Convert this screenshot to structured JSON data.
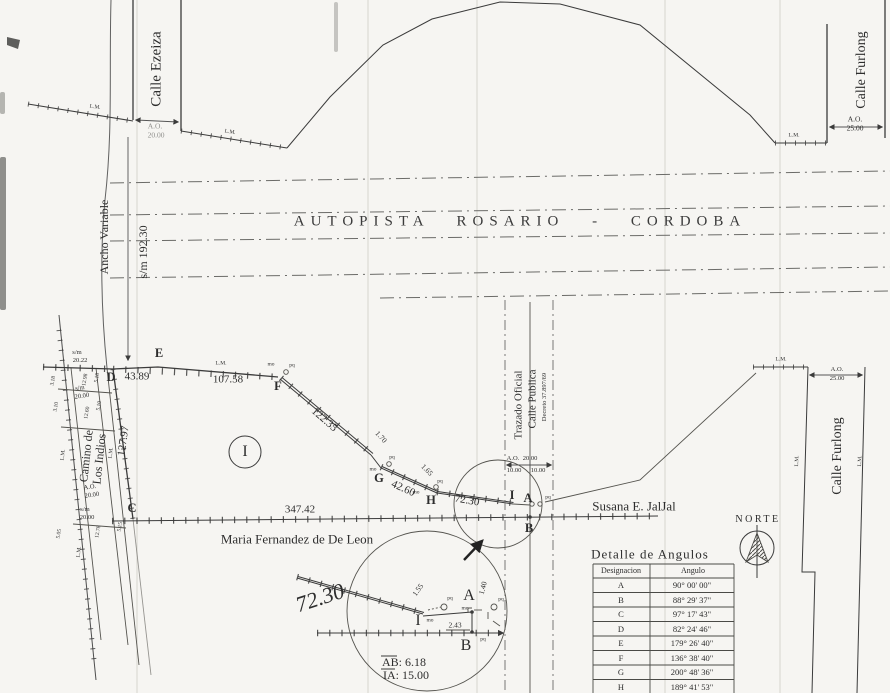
{
  "plan": {
    "autopista_title": "AUTOPISTA ROSARIO - CORDOBA",
    "north_label": "NORTE"
  },
  "streets": {
    "ezeiza": {
      "name": "Calle Ezeiza",
      "ao": "A.O.",
      "width": "20.00"
    },
    "furlong_top": {
      "name": "Calle Furlong",
      "ao": "A.O.",
      "width": "25.00"
    },
    "furlong_right": {
      "name": "Calle Furlong",
      "ao": "A.O.",
      "width": "25.00"
    },
    "autopista": {
      "ancho": "Ancho Variable",
      "sm": "s/m 192.30"
    },
    "camino": {
      "name1": "Camino de",
      "name2": "Los Indios",
      "ao": "A.O.",
      "ao_width": "20.00",
      "sm_top": "s/m",
      "sm_top_v": "20.22",
      "sm_mid": "s/m",
      "sm_mid_v": "20.00",
      "sm_bot": "s/m",
      "sm_bot_v": "20.00",
      "w_top": [
        "3.18",
        "12.98",
        "5.18"
      ],
      "w_mid": [
        "3.10",
        "12.60",
        "5.10"
      ],
      "w_bot": [
        "5.05",
        "12.78",
        "5.15"
      ]
    },
    "trazado": {
      "l1": "Trazado Oficial",
      "l2": "Calle Publica",
      "l3": "Decreto 37.897/69",
      "ao": "A.O.",
      "width": "20.00",
      "half1": "10.00",
      "half2": "10.00"
    }
  },
  "owners": {
    "south": "Maria Fernandez de De Leon",
    "east": "Susana E. JalJal"
  },
  "parcel": {
    "designation": "I",
    "points": {
      "a": "A",
      "b": "B",
      "c": "C",
      "d": "D",
      "e": "E",
      "f": "F",
      "g": "G",
      "h": "H",
      "i": "I"
    },
    "sides": {
      "de": "43.89",
      "ef": "107.58",
      "fg": "122.35",
      "gh": "42.60",
      "hi": "72.30",
      "cb": "347.42",
      "dc": "127.97",
      "off_g": "1.70",
      "off_h": "1.65"
    }
  },
  "markers": {
    "lm": "L.M.",
    "mo": "mo",
    "pq": "pq"
  },
  "detail": {
    "seg": "72.30",
    "off1": "1.55",
    "off2": "1.40",
    "off3": "2.43",
    "pa": "A",
    "pb": "B",
    "pi": "I",
    "ab": "AB: 6.18",
    "ia": "IA: 15.00"
  },
  "table": {
    "title": "Detalle de Angulos",
    "col1": "Designacion",
    "col2": "Angulo",
    "rows": [
      {
        "d": "A",
        "a": "90° 00' 00\""
      },
      {
        "d": "B",
        "a": "88° 29' 37\""
      },
      {
        "d": "C",
        "a": "97° 17' 43\""
      },
      {
        "d": "D",
        "a": "82° 24' 46\""
      },
      {
        "d": "E",
        "a": "179° 26' 40\""
      },
      {
        "d": "F",
        "a": "136° 38' 40\""
      },
      {
        "d": "G",
        "a": "200° 48' 36\""
      },
      {
        "d": "H",
        "a": "189° 41' 53\""
      },
      {
        "d": "I",
        "a": "195° 12' 05\""
      }
    ]
  }
}
